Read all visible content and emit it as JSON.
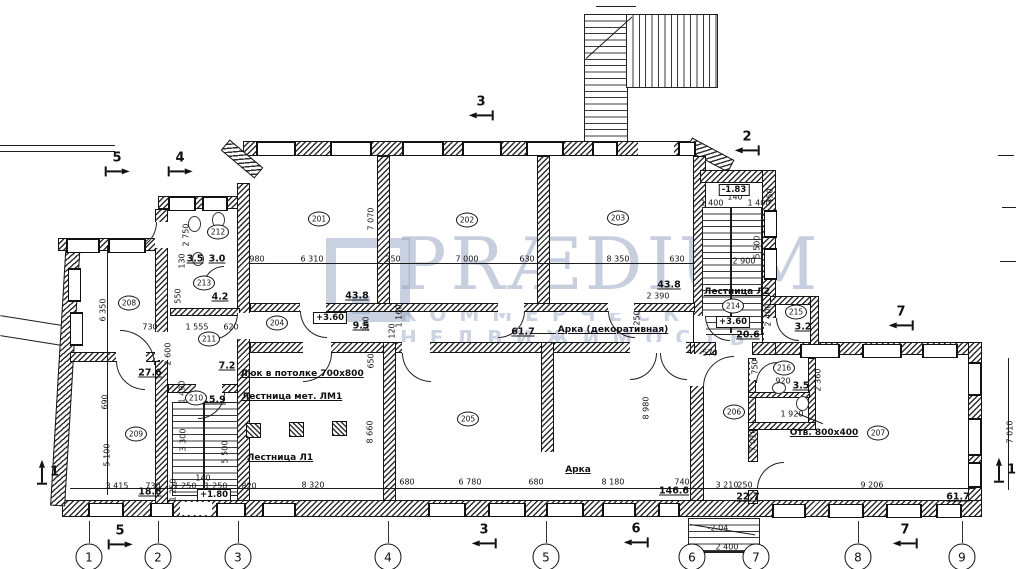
{
  "watermark": {
    "brand": "PRÆDIUM",
    "tagline": "КОММЕРЧЕСКАЯ НЕДВИЖИМОСТЬ",
    "color": "#94a3c2"
  },
  "plan": {
    "rooms": [
      {
        "num": "201",
        "x": 319,
        "y": 219
      },
      {
        "num": "202",
        "x": 467,
        "y": 220
      },
      {
        "num": "203",
        "x": 618,
        "y": 218
      },
      {
        "num": "204",
        "x": 277,
        "y": 323
      },
      {
        "num": "205",
        "x": 468,
        "y": 419
      },
      {
        "num": "206",
        "x": 734,
        "y": 412
      },
      {
        "num": "207",
        "x": 878,
        "y": 433
      },
      {
        "num": "208",
        "x": 129,
        "y": 303
      },
      {
        "num": "209",
        "x": 136,
        "y": 434
      },
      {
        "num": "210",
        "x": 196,
        "y": 398
      },
      {
        "num": "211",
        "x": 209,
        "y": 339
      },
      {
        "num": "212",
        "x": 218,
        "y": 232
      },
      {
        "num": "213",
        "x": 204,
        "y": 283
      },
      {
        "num": "214",
        "x": 733,
        "y": 306
      },
      {
        "num": "215",
        "x": 796,
        "y": 312
      },
      {
        "num": "216",
        "x": 784,
        "y": 368
      }
    ],
    "areas": [
      {
        "v": "43.8",
        "x": 357,
        "y": 296
      },
      {
        "v": "9.5",
        "x": 361,
        "y": 326
      },
      {
        "v": "43.8",
        "x": 669,
        "y": 285
      },
      {
        "v": "61.7",
        "x": 523,
        "y": 332
      },
      {
        "v": "20.6",
        "x": 748,
        "y": 335
      },
      {
        "v": "3.2",
        "x": 803,
        "y": 327
      },
      {
        "v": "3.5",
        "x": 801,
        "y": 386
      },
      {
        "v": "27.6",
        "x": 150,
        "y": 373
      },
      {
        "v": "15.9",
        "x": 214,
        "y": 400
      },
      {
        "v": "7.2",
        "x": 227,
        "y": 366
      },
      {
        "v": "4.2",
        "x": 220,
        "y": 297
      },
      {
        "v": "3.5",
        "x": 195,
        "y": 259
      },
      {
        "v": "3.0",
        "x": 217,
        "y": 259
      },
      {
        "v": "18.8",
        "x": 150,
        "y": 492
      },
      {
        "v": "146.6",
        "x": 674,
        "y": 491
      },
      {
        "v": "22.7",
        "x": 748,
        "y": 497
      },
      {
        "v": "61.7",
        "x": 958,
        "y": 497
      }
    ],
    "elevations": [
      {
        "v": "+3.60",
        "x": 330,
        "y": 318
      },
      {
        "v": "+3.60",
        "x": 733,
        "y": 322
      },
      {
        "v": "+1.80",
        "x": 214,
        "y": 495
      },
      {
        "v": "-1.83",
        "x": 734,
        "y": 190
      }
    ],
    "labels": [
      {
        "v": "Люк в потолке 700х800",
        "x": 302,
        "y": 374
      },
      {
        "v": "Лестница мет. ЛМ1",
        "x": 292,
        "y": 397
      },
      {
        "v": "Лестница Л1",
        "x": 280,
        "y": 458
      },
      {
        "v": "Лестница Л2",
        "x": 737,
        "y": 292
      },
      {
        "v": "Арка (декоративная)",
        "x": 613,
        "y": 330
      },
      {
        "v": "Арка",
        "x": 578,
        "y": 470
      },
      {
        "v": "Отв. 800х400",
        "x": 824,
        "y": 433
      }
    ],
    "dims": [
      {
        "v": "980",
        "x": 257,
        "y": 259
      },
      {
        "v": "6 310",
        "x": 312,
        "y": 259
      },
      {
        "v": "250",
        "x": 393,
        "y": 259
      },
      {
        "v": "7 000",
        "x": 467,
        "y": 259
      },
      {
        "v": "630",
        "x": 527,
        "y": 259
      },
      {
        "v": "8 350",
        "x": 618,
        "y": 259
      },
      {
        "v": "630",
        "x": 677,
        "y": 259
      },
      {
        "v": "7 070",
        "x": 371,
        "y": 219,
        "rot": true
      },
      {
        "v": "2 750",
        "x": 186,
        "y": 235,
        "rot": true
      },
      {
        "v": "130",
        "x": 182,
        "y": 261,
        "rot": true
      },
      {
        "v": "550",
        "x": 178,
        "y": 296,
        "rot": true
      },
      {
        "v": "730",
        "x": 150,
        "y": 327
      },
      {
        "v": "1 555",
        "x": 197,
        "y": 327
      },
      {
        "v": "620",
        "x": 231,
        "y": 327
      },
      {
        "v": "2 600",
        "x": 168,
        "y": 354,
        "rot": true
      },
      {
        "v": "1 490",
        "x": 182,
        "y": 392,
        "rot": true
      },
      {
        "v": "3 300",
        "x": 183,
        "y": 440,
        "rot": true
      },
      {
        "v": "5 500",
        "x": 225,
        "y": 452,
        "rot": true
      },
      {
        "v": "1 250",
        "x": 173,
        "y": 490,
        "rot": true
      },
      {
        "v": "6 350",
        "x": 103,
        "y": 310,
        "rot": true
      },
      {
        "v": "690",
        "x": 105,
        "y": 402,
        "rot": true
      },
      {
        "v": "5 100",
        "x": 107,
        "y": 455,
        "rot": true
      },
      {
        "v": "3 415",
        "x": 117,
        "y": 486
      },
      {
        "v": "730",
        "x": 153,
        "y": 486
      },
      {
        "v": "1 250",
        "x": 185,
        "y": 486
      },
      {
        "v": "140",
        "x": 203,
        "y": 478
      },
      {
        "v": "1 250",
        "x": 216,
        "y": 486
      },
      {
        "v": "820",
        "x": 249,
        "y": 486
      },
      {
        "v": "8 320",
        "x": 313,
        "y": 485
      },
      {
        "v": "680",
        "x": 407,
        "y": 482
      },
      {
        "v": "6 780",
        "x": 470,
        "y": 482
      },
      {
        "v": "680",
        "x": 536,
        "y": 482
      },
      {
        "v": "8 180",
        "x": 613,
        "y": 482
      },
      {
        "v": "740",
        "x": 682,
        "y": 482
      },
      {
        "v": "3 210",
        "x": 727,
        "y": 485
      },
      {
        "v": "250",
        "x": 745,
        "y": 485
      },
      {
        "v": "9 206",
        "x": 872,
        "y": 485
      },
      {
        "v": "2 400",
        "x": 727,
        "y": 547
      },
      {
        "v": "300",
        "x": 366,
        "y": 324,
        "rot": true
      },
      {
        "v": "120",
        "x": 392,
        "y": 331,
        "rot": true
      },
      {
        "v": "1 160",
        "x": 399,
        "y": 316,
        "rot": true
      },
      {
        "v": "650",
        "x": 371,
        "y": 361,
        "rot": true
      },
      {
        "v": "8 660",
        "x": 370,
        "y": 432,
        "rot": true
      },
      {
        "v": "8 980",
        "x": 646,
        "y": 408,
        "rot": true
      },
      {
        "v": "2 390",
        "x": 658,
        "y": 296
      },
      {
        "v": "250",
        "x": 637,
        "y": 318,
        "rot": true
      },
      {
        "v": "140",
        "x": 735,
        "y": 197
      },
      {
        "v": "1 400",
        "x": 712,
        "y": 203
      },
      {
        "v": "1 400",
        "x": 759,
        "y": 203
      },
      {
        "v": "450",
        "x": 770,
        "y": 196,
        "rot": true
      },
      {
        "v": "2 900",
        "x": 744,
        "y": 261
      },
      {
        "v": "5 500",
        "x": 757,
        "y": 247,
        "rot": true
      },
      {
        "v": "2 400",
        "x": 768,
        "y": 315,
        "rot": true
      },
      {
        "v": "570",
        "x": 710,
        "y": 353
      },
      {
        "v": "920",
        "x": 783,
        "y": 381
      },
      {
        "v": "750",
        "x": 755,
        "y": 367,
        "rot": true
      },
      {
        "v": "2 360",
        "x": 818,
        "y": 380,
        "rot": true
      },
      {
        "v": "1 920",
        "x": 792,
        "y": 414
      },
      {
        "v": "7 010",
        "x": 753,
        "y": 440,
        "rot": true
      },
      {
        "v": "7 010",
        "x": 1010,
        "y": 432,
        "rot": true
      },
      {
        "v": "-2.04",
        "x": 718,
        "y": 528
      }
    ],
    "axes": [
      {
        "n": "1",
        "x": 89
      },
      {
        "n": "2",
        "x": 158
      },
      {
        "n": "3",
        "x": 238
      },
      {
        "n": "4",
        "x": 388
      },
      {
        "n": "5",
        "x": 546
      },
      {
        "n": "6",
        "x": 692
      },
      {
        "n": "7",
        "x": 756
      },
      {
        "n": "8",
        "x": 858
      },
      {
        "n": "9",
        "x": 962
      }
    ],
    "axis_y": 557,
    "sections": [
      {
        "n": "3",
        "x": 481,
        "y": 110,
        "dir": "left"
      },
      {
        "n": "2",
        "x": 747,
        "y": 145,
        "dir": "left"
      },
      {
        "n": "5",
        "x": 117,
        "y": 166,
        "dir": "right"
      },
      {
        "n": "4",
        "x": 180,
        "y": 166,
        "dir": "right"
      },
      {
        "n": "5",
        "x": 120,
        "y": 539,
        "dir": "right"
      },
      {
        "n": "3",
        "x": 484,
        "y": 538,
        "dir": "left"
      },
      {
        "n": "6",
        "x": 636,
        "y": 537,
        "dir": "left"
      },
      {
        "n": "7",
        "x": 905,
        "y": 538,
        "dir": "left"
      },
      {
        "n": "7",
        "x": 901,
        "y": 320,
        "dir": "left"
      },
      {
        "n": "1",
        "x": 1005,
        "y": 470,
        "dir": "up"
      },
      {
        "n": "1",
        "x": 48,
        "y": 472,
        "dir": "up"
      }
    ]
  }
}
